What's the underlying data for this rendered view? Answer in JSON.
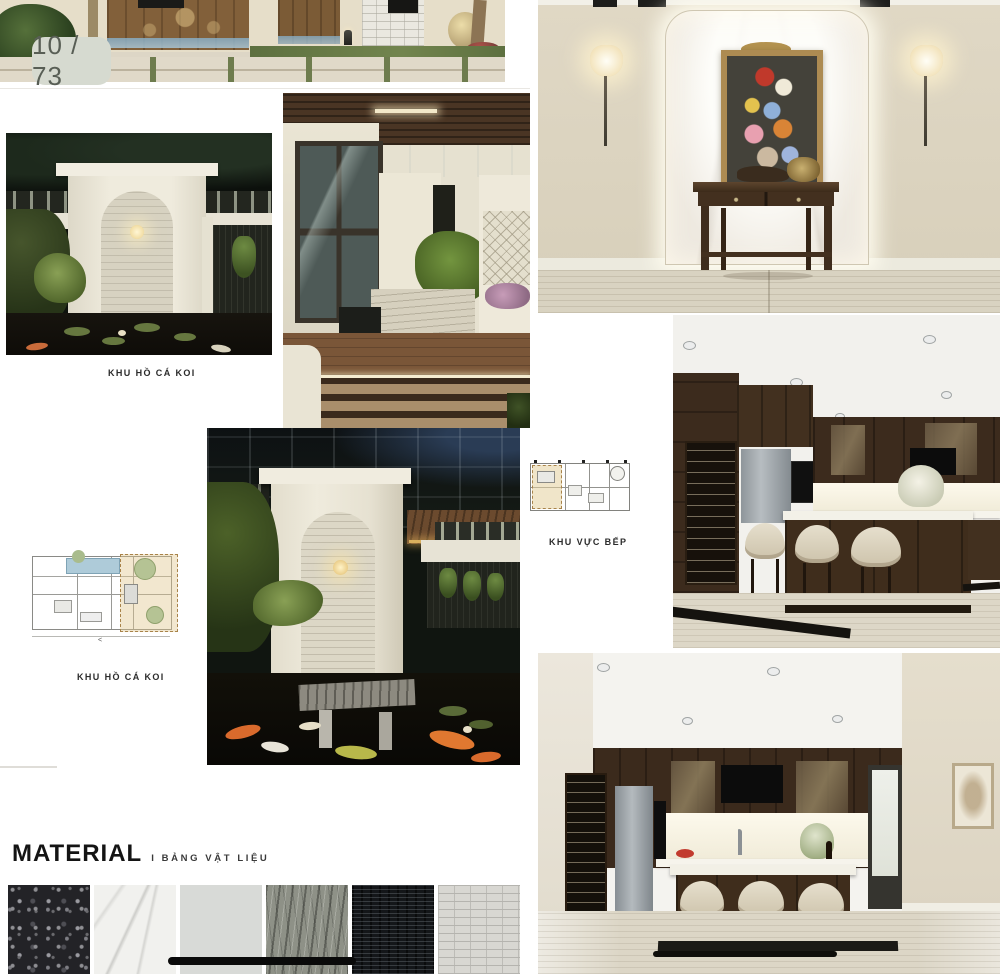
{
  "viewer": {
    "page_indicator": "10 / 73"
  },
  "document": {
    "labels": {
      "koi_day": "KHU HỒ CÁ KOI",
      "koi_night": "KHU HỒ CÁ KOI",
      "kitchen_area": "KHU VỰC BẾP"
    },
    "material_section": {
      "title": "MATERIAL",
      "subtitle": "I BẢNG VẬT LIỆU"
    },
    "material_swatches": [
      "black-speckled-granite",
      "white-marble",
      "plain-grey-stone",
      "grey-wave-textured-stone",
      "black-slate-ledger",
      "light-grey-brick-tile"
    ]
  },
  "colors": {
    "page_pill_bg": "#d6dad0",
    "page_pill_text": "#585e55",
    "wall_cream": "#ddd5c2",
    "wood_dark": "#3f2d1c",
    "label_text": "#2b2b2b",
    "home_bar": "#0a0a0a"
  }
}
